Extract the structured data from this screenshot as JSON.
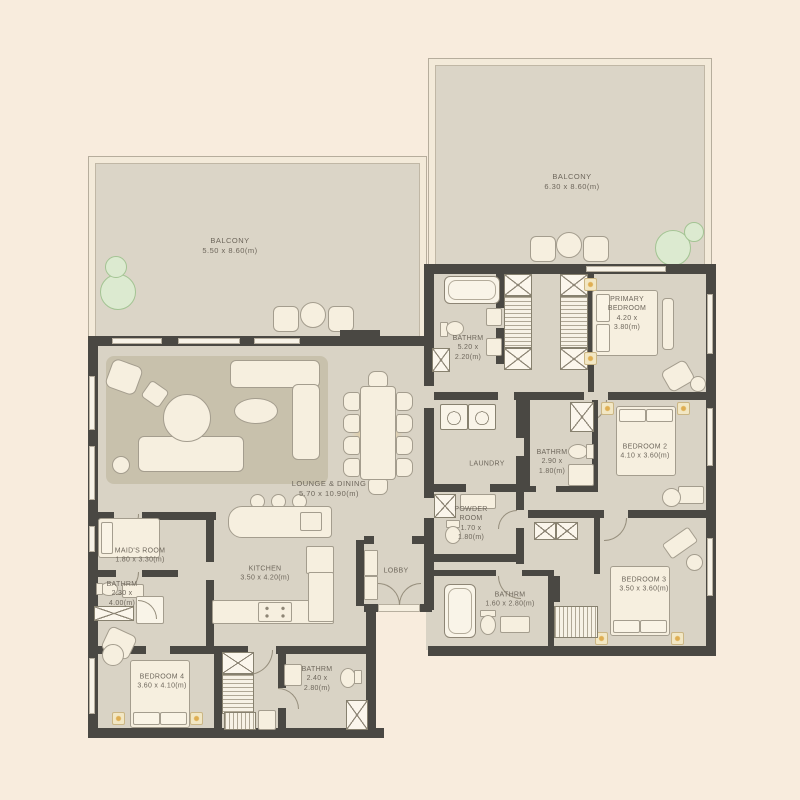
{
  "type": "apartment-floor-plan",
  "palette": {
    "background": "#f8ecdd",
    "floor": "#d9d3c5",
    "balcony_floor": "#dbd5c7",
    "wall": "#4a4843",
    "furniture": "#f6efdf",
    "rug": "#c8c1ac",
    "plant": "#dcead0",
    "glow": "#e9bc60",
    "label_text": "#6e675c"
  },
  "rooms": {
    "balcony_left": {
      "lines": [
        "BALCONY",
        "5.50 x 8.60(m)"
      ]
    },
    "balcony_right": {
      "lines": [
        "BALCONY",
        "6.30 x 8.60(m)"
      ]
    },
    "lounge_dining": {
      "lines": [
        "LOUNGE & DINING",
        "5.70 x 10.90(m)"
      ]
    },
    "bathrm_primary": {
      "lines": [
        "BATHRM",
        "5.20 x",
        "2.20(m)"
      ]
    },
    "primary_bedroom": {
      "lines": [
        "PRIMARY",
        "BEDROOM",
        "4.20 x",
        "3.80(m)"
      ]
    },
    "laundry": {
      "lines": [
        "LAUNDRY"
      ]
    },
    "powder_room": {
      "lines": [
        "POWDER",
        "ROOM",
        "1.70 x",
        "1.80(m)"
      ]
    },
    "bathrm_bed2": {
      "lines": [
        "BATHRM",
        "2.90 x",
        "1.80(m)"
      ]
    },
    "bedroom2": {
      "lines": [
        "BEDROOM 2",
        "4.10 x 3.60(m)"
      ]
    },
    "bedroom3": {
      "lines": [
        "BEDROOM 3",
        "3.50 x 3.60(m)"
      ]
    },
    "bathrm_bed3": {
      "lines": [
        "BATHRM",
        "1.60 x 2.80(m)"
      ]
    },
    "lobby": {
      "lines": [
        "LOBBY"
      ]
    },
    "kitchen": {
      "lines": [
        "KITCHEN",
        "3.50 x 4.20(m)"
      ]
    },
    "maids_room": {
      "lines": [
        "MAID'S ROOM",
        "1.80 x 3.30(m)"
      ]
    },
    "bathrm_maids": {
      "lines": [
        "BATHRM",
        "2.30 x",
        "4.00(m)"
      ]
    },
    "bedroom4": {
      "lines": [
        "BEDROOM 4",
        "3.60 x 4.10(m)"
      ]
    },
    "bathrm_bed4": {
      "lines": [
        "BATHRM",
        "2.40 x",
        "2.80(m)"
      ]
    }
  }
}
